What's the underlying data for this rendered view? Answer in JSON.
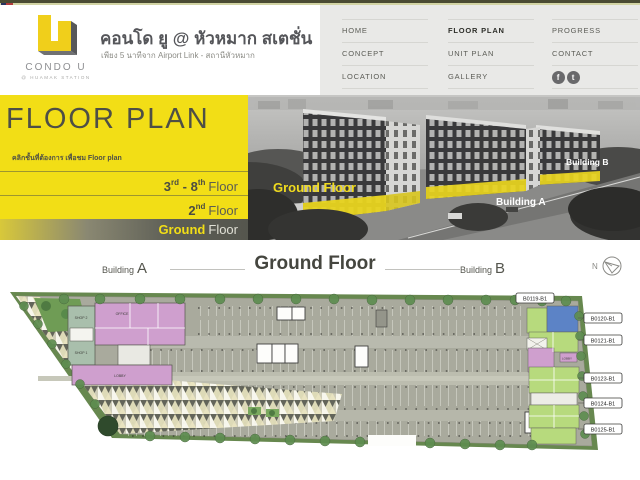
{
  "brand": {
    "logo_text": "CONDO U",
    "logo_sub": "@ HUAMAK STATION",
    "title": "คอนโด ยู @ หัวหมาก สเตชั่น",
    "subtitle": "เพียง 5 นาทีจาก Airport Link - สถานีหัวหมาก"
  },
  "nav": {
    "home": "HOME",
    "concept": "CONCEPT",
    "location": "LOCATION",
    "floor_plan": "FLOOR PLAN",
    "unit_plan": "UNIT PLAN",
    "gallery": "GALLERY",
    "progress": "PROGRESS",
    "contact": "CONTACT",
    "facebook_glyph": "f",
    "twitter_glyph": "t"
  },
  "floor_panel": {
    "title": "FLOOR PLAN",
    "instruction": "คลิกชั้นที่ต้องการ เพื่อชม Floor plan",
    "floor_3_8": {
      "n1": "3",
      "s1": "rd",
      "sep": " - ",
      "n2": "8",
      "s2": "th",
      "word": "Floor"
    },
    "floor_2": {
      "n1": "2",
      "s1": "nd",
      "word": "Floor"
    },
    "ground": {
      "bold": "Ground",
      "word": "Floor"
    }
  },
  "hero": {
    "ground_floor": "Ground Floor",
    "building_a": "Building A",
    "building_b": "Building B"
  },
  "plan_header": {
    "building_word": "Building",
    "building_a_letter": "A",
    "title": "Ground Floor",
    "building_b_letter": "B",
    "compass_n": "N"
  },
  "floor_plan": {
    "unit_labels": [
      "B0119-B1",
      "B0120-B1",
      "B0121-B1",
      "B0123-B1",
      "B0124-B1",
      "B0125-B1"
    ],
    "rooms": {
      "shop2": "SHOP 2",
      "shop1": "SHOP 1",
      "office": "OFFICE",
      "lobby": "LOBBY",
      "lobby_b": "LOBBY"
    }
  },
  "colors": {
    "accent_yellow": "#f2de16",
    "dark_gray": "#58595b",
    "nav_bg": "#e9e9e7",
    "unit_green": "#b7da7d",
    "unit_blue": "#5c83c6",
    "unit_pink": "#cf9fce",
    "shop_sage": "#a9bfac",
    "pavement": "#a9aa9d"
  }
}
